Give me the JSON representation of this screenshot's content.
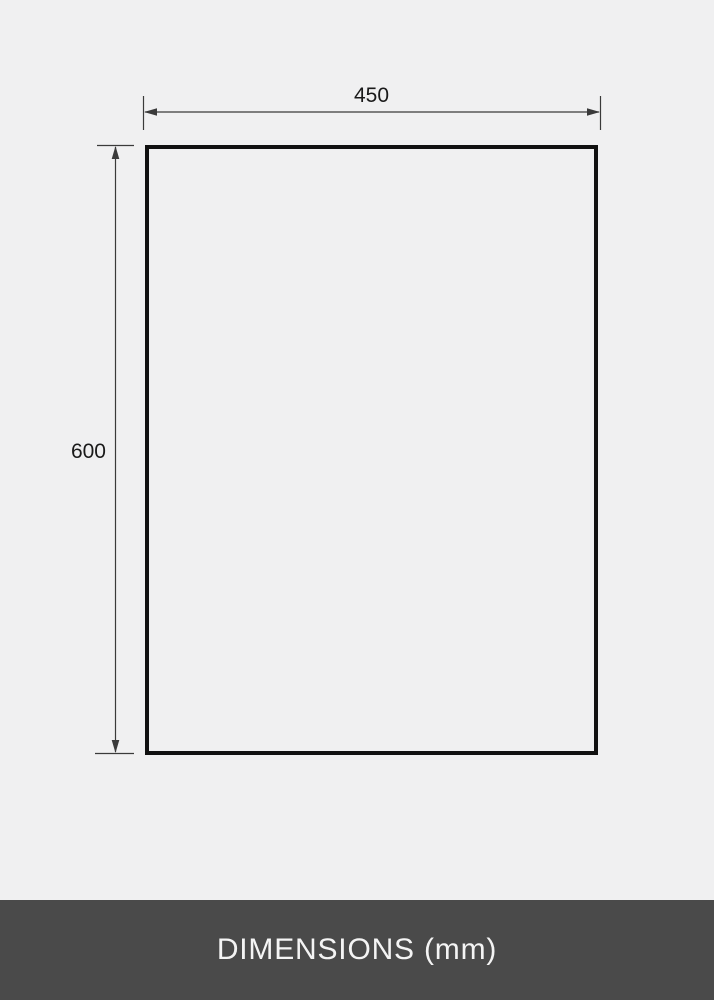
{
  "diagram": {
    "width_label": "450",
    "height_label": "600",
    "caption": "DIMENSIONS (mm)"
  },
  "icons": {
    "width_arrows": "double-headed-horizontal-arrow",
    "height_arrows": "double-headed-vertical-arrow"
  },
  "colors": {
    "background": "#f0f0f1",
    "outline": "#111111",
    "dimension_line": "#3a3a3a",
    "label_text": "#1a1a1a",
    "footer_background": "#4a4a4a",
    "footer_text": "#f4f4f4"
  }
}
